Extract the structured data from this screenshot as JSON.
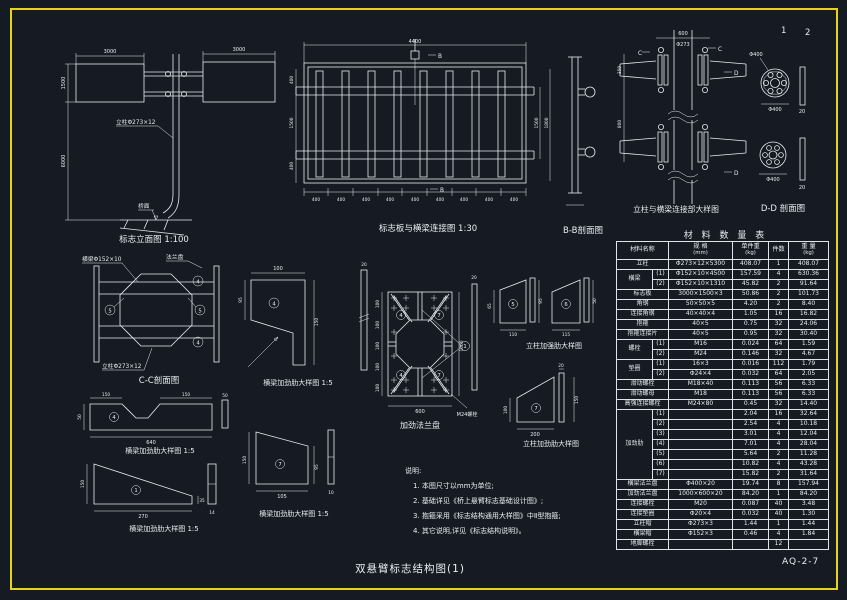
{
  "page": {
    "sheet_no_1": "1",
    "sheet_no_2": "2",
    "drawing_no": "AQ-2-7",
    "title": "双悬臂标志结构图(1)"
  },
  "colors": {
    "background": "#161a22",
    "frame": "#e5d31c",
    "line": "#e9edf2"
  },
  "captions": {
    "elevation": "标志立面图 1:100",
    "panel_beam": "标志板与横梁连接图 1:30",
    "section_bb": "B-B剖面图",
    "column_beam": "立柱与横梁连接部大样图",
    "section_dd": "D-D 剖面图",
    "section_cc": "C-C剖面图",
    "beam_rib": "横梁加劲肋大样图 1:5",
    "col_rib_strong": "立柱加强肋大样图",
    "col_rib": "立柱加劲肋大样图",
    "flange_plate": "加劲法兰盘"
  },
  "labels": {
    "pole": "立柱Φ273×12",
    "deck": "桥面",
    "beam": "横梁Φ152×10",
    "flange": "法兰盘",
    "bolt": "M24螺栓",
    "b": "B",
    "c": "C",
    "d": "D"
  },
  "marks": {
    "m1": "1",
    "m4": "4",
    "m5": "5",
    "m6": "6",
    "m7": "7"
  },
  "dims": {
    "elevation": {
      "panel_left": "3000",
      "panel_right": "3000",
      "panel_h": "1500",
      "pole_h": "6000"
    },
    "panel_beam": {
      "top": "4400",
      "left_top": "400",
      "left_mid": "1500",
      "left_bot": "400",
      "right_in": "1500",
      "right_out": "1800",
      "seg": "400"
    },
    "column_beam": {
      "top": "600",
      "pole": "Φ273",
      "upper": "350",
      "lower": "800"
    },
    "section_dd": {
      "flange": "Φ400",
      "bar": "20"
    },
    "rib_a": {
      "top": "100",
      "left": "95",
      "right": "150"
    },
    "flange_plate": {
      "grid": "100",
      "bottom": "600",
      "right": "1000",
      "bar": "20"
    },
    "rib5": {
      "left": "65",
      "right": "95",
      "bottom": "110"
    },
    "rib6": {
      "right": "50",
      "bottom": "115"
    },
    "col_rib_big": {
      "left": "100",
      "bottom": "200",
      "right": "150",
      "bar": "20"
    },
    "rib_notched": {
      "top_l": "150",
      "top_r": "150",
      "bottom": "640",
      "left": "50",
      "bar": "50"
    },
    "rib_tri": {
      "left": "150",
      "bottom": "270",
      "right": "35",
      "bar": "14"
    },
    "rib_trap": {
      "left": "150",
      "right": "95",
      "bottom": "105",
      "bar": "10"
    }
  },
  "notes": {
    "title": "说明:",
    "items": [
      "1. 本图尺寸以mm为单位;",
      "2. 基础详见《桥上悬臂标志基础设计图》;",
      "3. 抱箍采用《标志结构通用大样图》中Ⅱ型抱箍;",
      "4. 其它说明,详见《标志结构说明》。"
    ]
  },
  "material_table": {
    "title": "材 料 数 量 表",
    "headers": {
      "name": "材料名称",
      "spec": "规 格",
      "spec_unit": "(mm)",
      "unit": "单件重",
      "unit_unit": "(kg)",
      "qty": "件数",
      "weight": "重 量",
      "weight_unit": "(kg)"
    },
    "rows": [
      {
        "name": "立柱",
        "spec": "Φ273×12×5300",
        "unit": "408.07",
        "qty": "1",
        "wt": "408.07"
      },
      {
        "g": "横梁",
        "gspan": 2,
        "sub": "(1)",
        "spec": "Φ152×10×4500",
        "unit": "157.59",
        "qty": "4",
        "wt": "630.36"
      },
      {
        "sub": "(2)",
        "spec": "Φ152×10×1310",
        "unit": "45.82",
        "qty": "2",
        "wt": "91.64"
      },
      {
        "name": "标志板",
        "spec": "3000×1500×3",
        "unit": "50.86",
        "qty": "2",
        "wt": "101.73"
      },
      {
        "name": "角钢",
        "spec": "50×50×5",
        "unit": "4.20",
        "qty": "2",
        "wt": "8.40"
      },
      {
        "name": "连接角钢",
        "spec": "40×40×4",
        "unit": "1.05",
        "qty": "16",
        "wt": "16.82"
      },
      {
        "name": "抱箍",
        "spec": "40×5",
        "unit": "0.75",
        "qty": "32",
        "wt": "24.06"
      },
      {
        "name": "抱箍连接片",
        "spec": "40×5",
        "unit": "0.95",
        "qty": "32",
        "wt": "30.40"
      },
      {
        "g": "螺栓",
        "gspan": 2,
        "sub": "(1)",
        "spec": "M16",
        "unit": "0.024",
        "qty": "64",
        "wt": "1.59"
      },
      {
        "sub": "(2)",
        "spec": "M24",
        "unit": "0.146",
        "qty": "32",
        "wt": "4.67"
      },
      {
        "g": "垫圈",
        "gspan": 2,
        "sub": "(1)",
        "spec": "16×3",
        "unit": "0.016",
        "qty": "112",
        "wt": "1.79"
      },
      {
        "sub": "(2)",
        "spec": "Φ24×4",
        "unit": "0.032",
        "qty": "64",
        "wt": "2.05"
      },
      {
        "name": "滑动螺栓",
        "spec": "M18×40",
        "unit": "0.113",
        "qty": "56",
        "wt": "6.33"
      },
      {
        "name": "滑动螺母",
        "spec": "M18",
        "unit": "0.113",
        "qty": "56",
        "wt": "6.33"
      },
      {
        "name": "高强连接螺栓",
        "spec": "M24×80",
        "unit": "0.45",
        "qty": "32",
        "wt": "14.40"
      },
      {
        "g": "加劲肋",
        "gspan": 7,
        "sub": "(1)",
        "spec": "",
        "unit": "2.04",
        "qty": "16",
        "wt": "32.64"
      },
      {
        "sub": "(2)",
        "spec": "",
        "unit": "2.54",
        "qty": "4",
        "wt": "10.18"
      },
      {
        "sub": "(3)",
        "spec": "",
        "unit": "3.01",
        "qty": "4",
        "wt": "12.04"
      },
      {
        "sub": "(4)",
        "spec": "",
        "unit": "7.01",
        "qty": "4",
        "wt": "28.04"
      },
      {
        "sub": "(5)",
        "spec": "",
        "unit": "5.64",
        "qty": "2",
        "wt": "11.28"
      },
      {
        "sub": "(6)",
        "spec": "",
        "unit": "10.82",
        "qty": "4",
        "wt": "43.28"
      },
      {
        "sub": "(7)",
        "spec": "",
        "unit": "15.82",
        "qty": "2",
        "wt": "31.64"
      },
      {
        "name": "横梁法兰盘",
        "spec": "Φ400×20",
        "unit": "19.74",
        "qty": "8",
        "wt": "157.94"
      },
      {
        "name": "加劲法兰盘",
        "spec": "1000×600×20",
        "unit": "84.20",
        "qty": "1",
        "wt": "84.20"
      },
      {
        "name": "连接螺栓",
        "spec": "M20",
        "unit": "0.087",
        "qty": "40",
        "wt": "3.48"
      },
      {
        "name": "连接垫圈",
        "spec": "Φ20×4",
        "unit": "0.032",
        "qty": "40",
        "wt": "1.30"
      },
      {
        "name": "立柱帽",
        "spec": "Φ273×3",
        "unit": "1.44",
        "qty": "1",
        "wt": "1.44"
      },
      {
        "name": "横梁帽",
        "spec": "Φ152×3",
        "unit": "0.46",
        "qty": "4",
        "wt": "1.84"
      },
      {
        "name": "地脚螺栓",
        "spec": "",
        "unit": "",
        "qty": "12",
        "wt": ""
      }
    ]
  }
}
